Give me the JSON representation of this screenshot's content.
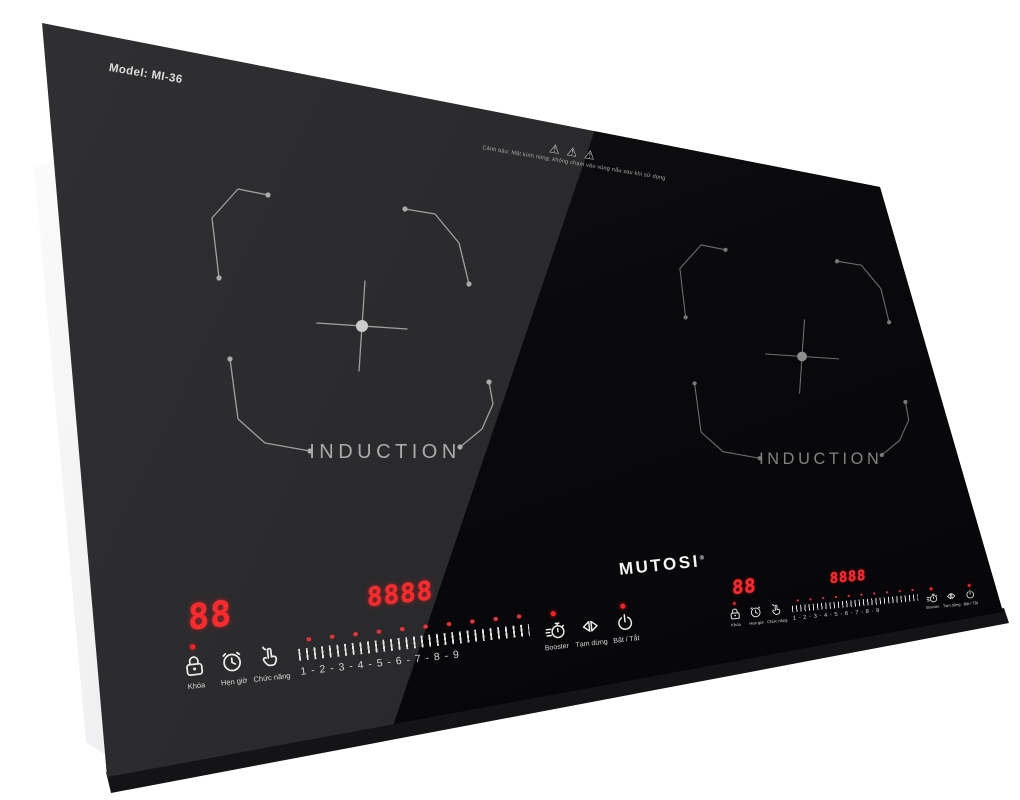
{
  "product": {
    "model_label": "Model: MI-36",
    "brand": "MUTOSI",
    "brand_mark": "®",
    "warning": {
      "glyph": "⚠",
      "icons": [
        "hot-surface-warning-triangle",
        "general-warning-triangle",
        "electric-warning-triangle"
      ],
      "text": "Cảnh báo: Mặt kính nóng, không chạm vào vùng nấu sau khi sử dụng"
    },
    "zones": {
      "left": {
        "label": "INDUCTION"
      },
      "right": {
        "label": "INDUCTION"
      }
    },
    "panel": {
      "display_small": "88",
      "display_large": "8888",
      "levels": "1 - 2 - 3 - 4 - 5 - 6 - 7 - 8 - 9",
      "buttons": [
        {
          "name": "lock",
          "label": "Khóa"
        },
        {
          "name": "timer",
          "label": "Hẹn giờ"
        },
        {
          "name": "function",
          "label": "Chức năng"
        },
        {
          "name": "booster",
          "label": "Booster"
        },
        {
          "name": "pause",
          "label": "Tạm dừng"
        },
        {
          "name": "power",
          "label": "Bật / Tắt"
        }
      ]
    },
    "colors": {
      "led_red": "#ff2a2e",
      "glass_light": "#29292b",
      "glass_dark": "#0a0a0c",
      "steel": "#c9c9cc",
      "background": "#ffffff"
    }
  }
}
